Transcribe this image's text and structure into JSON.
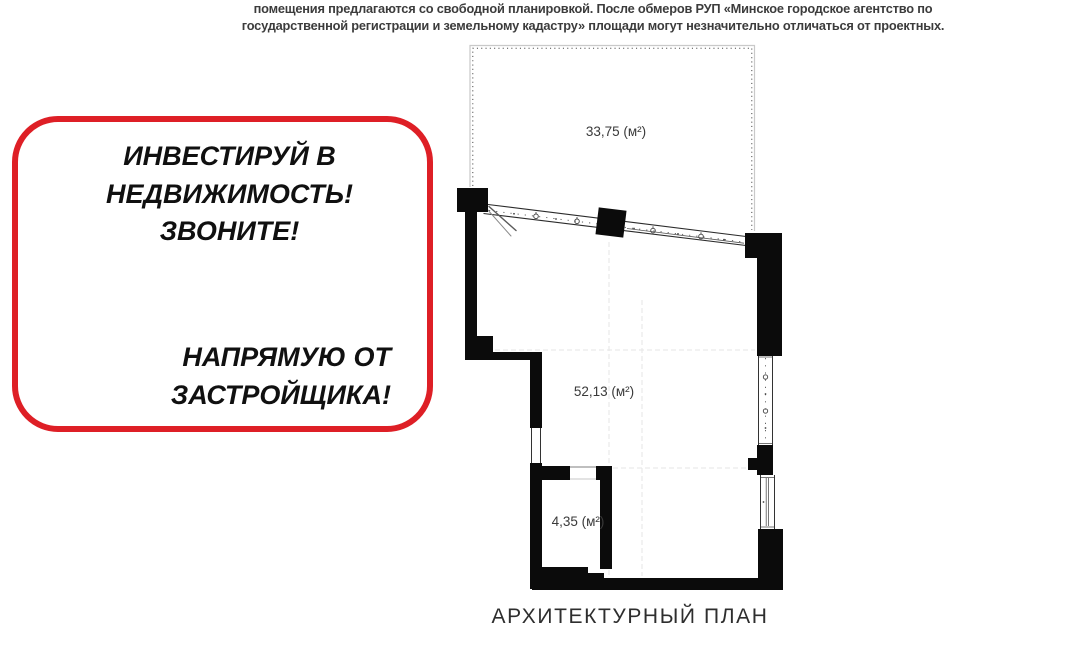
{
  "disclaimer": {
    "lines": [
      "помещения предлагаются со свободной планировкой. После обмеров РУП «Минское городское агентство по",
      "государственной регистрации и земельному кадастру» площади могут незначительно отличаться от проектных."
    ]
  },
  "ad_badge": {
    "border_color": "#de1f26",
    "text_color": "#101010",
    "top_lines": [
      "ИНВЕСТИРУЙ В",
      "НЕДВИЖИМОСТЬ!",
      "ЗВОНИТЕ!"
    ],
    "bottom_lines": [
      "НАПРЯМУЮ ОТ",
      "ЗАСТРОЙЩИКА!"
    ]
  },
  "floor_plan": {
    "caption": "АРХИТЕКТУРНЫЙ ПЛАН",
    "wall_color": "#0b0b0b",
    "areas": [
      {
        "name": "terrace",
        "label": "33,75 (м²)"
      },
      {
        "name": "main-room",
        "label": "52,13 (м²)"
      },
      {
        "name": "bathroom",
        "label": "4,35 (м²)"
      }
    ]
  }
}
